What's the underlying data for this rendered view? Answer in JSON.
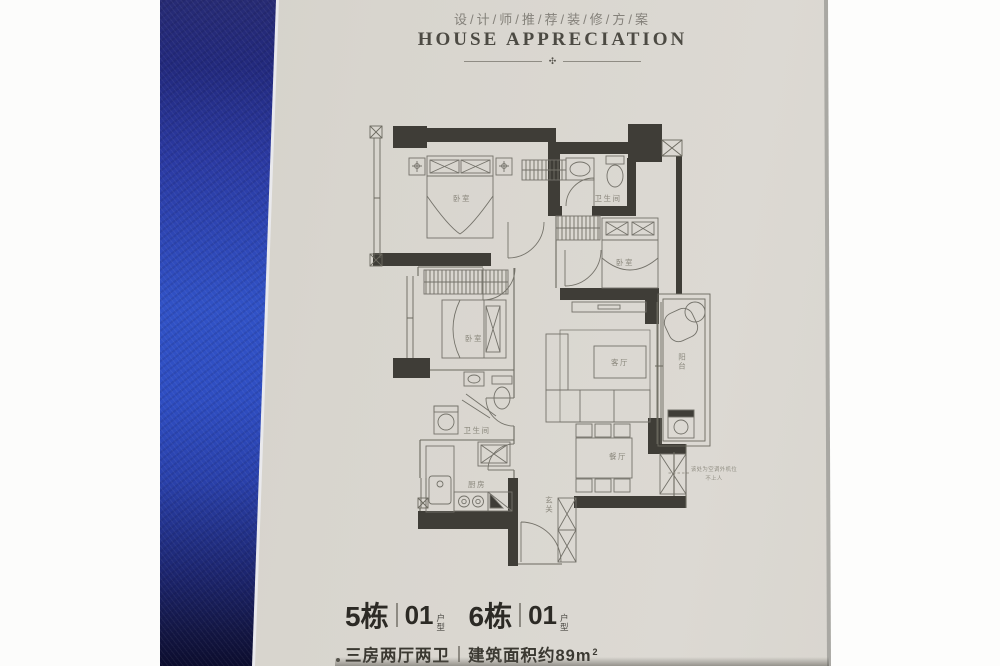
{
  "header": {
    "title_cn": "设/计/师/推/荐/装/修/方/案",
    "title_en": "HOUSE APPRECIATION",
    "ornament": "✣"
  },
  "floor_plan": {
    "rooms": {
      "bedroom_master": "卧室",
      "bathroom_top": "卫生间",
      "bedroom_right": "卧室",
      "bedroom_mid": "卧室",
      "living_room": "客厅",
      "balcony": "阳台",
      "bathroom_mid": "卫生间",
      "dining_room": "餐厅",
      "kitchen": "厨房",
      "entrance": "玄关"
    },
    "annotation": {
      "line1": "该处为空调外机位",
      "line2": "不上人"
    }
  },
  "footer": {
    "units": [
      {
        "building": "5栋",
        "unit": "01",
        "unit_suffix": "户型"
      },
      {
        "building": "6栋",
        "unit": "01",
        "unit_suffix": "户型"
      }
    ],
    "layout": "三房两厅两卫",
    "area": "建筑面积约89m",
    "area_sup": "2"
  },
  "colors": {
    "paper": "#d8d5ce",
    "fabric_blue": "#3152c6",
    "wall_ink": "#3f3d37",
    "text_ink": "#2c2a25"
  }
}
